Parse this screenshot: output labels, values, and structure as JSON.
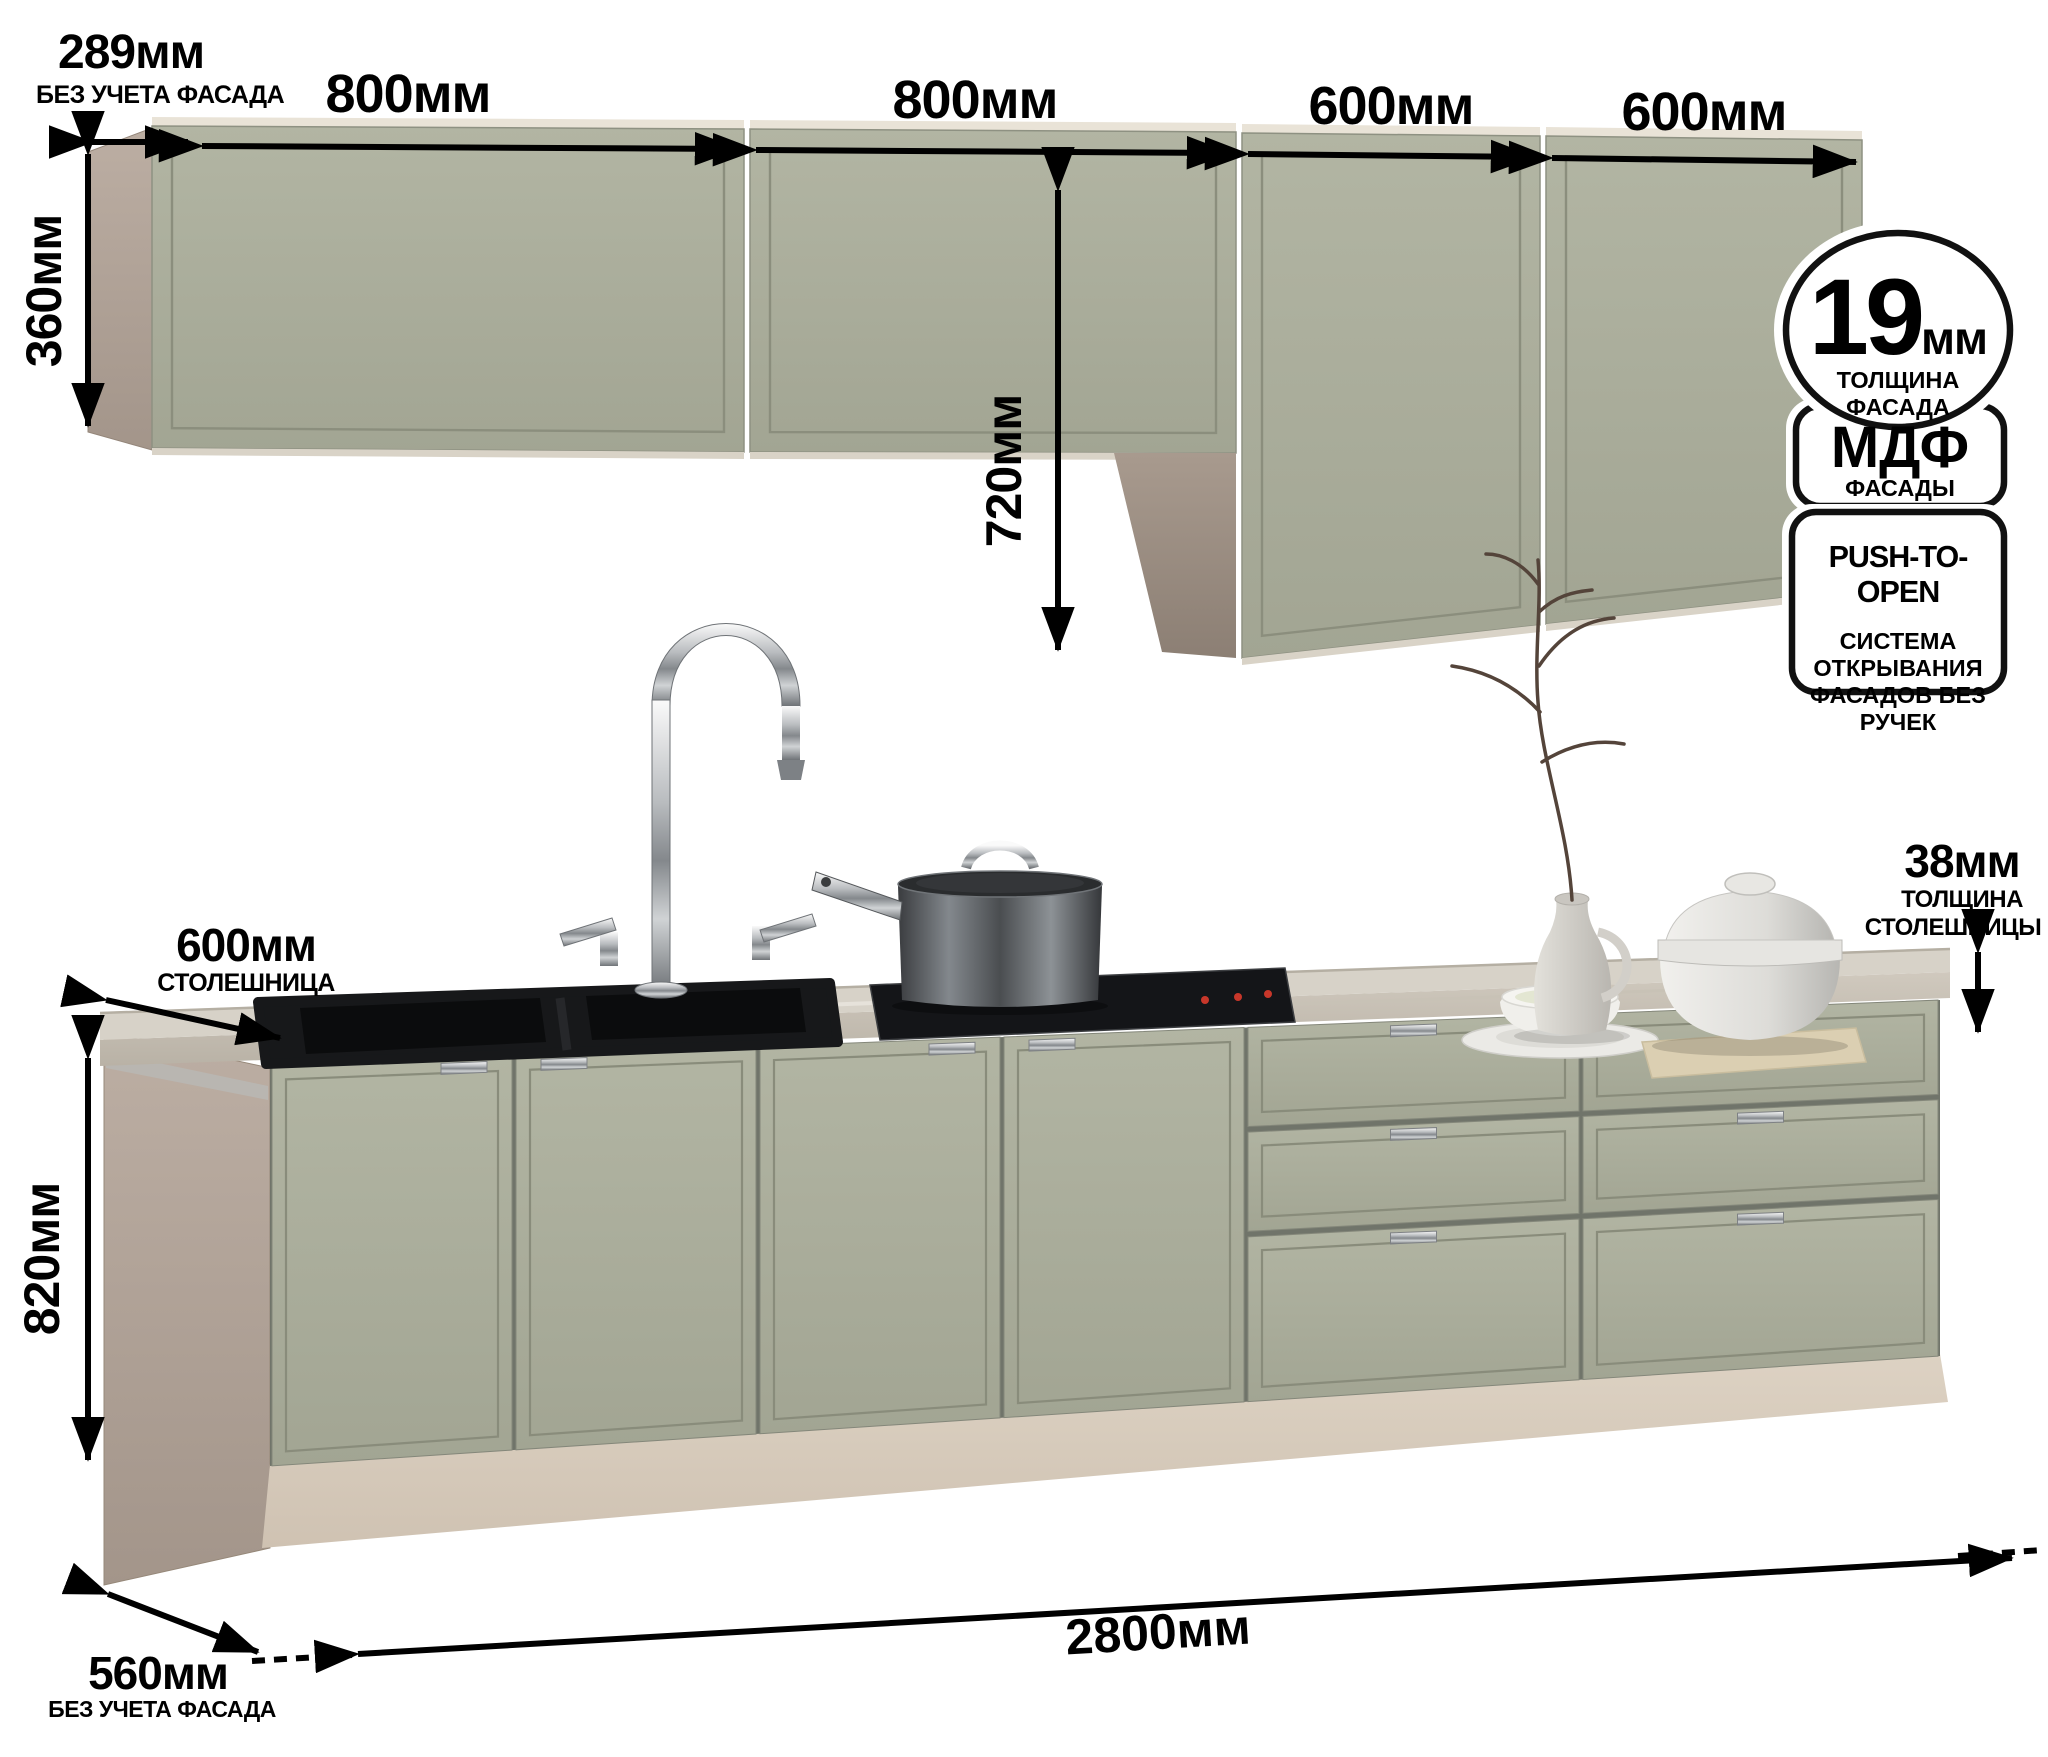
{
  "product": {
    "dimensions": {
      "side_depth_top": {
        "value": "289мм",
        "note": "БЕЗ УЧЕТА ФАСАДА"
      },
      "wall_cab_1": "800мм",
      "wall_cab_2": "800мм",
      "tall_cab_1": "600мм",
      "tall_cab_2": "600мм",
      "wall_cab_height": "360мм",
      "tall_cab_height": "720мм",
      "countertop_depth": {
        "value": "600мм",
        "note": "СТОЛЕШНИЦА"
      },
      "countertop_thickness": {
        "value": "38мм",
        "note1": "ТОЛЩИНА",
        "note2": "СТОЛЕШНИЦЫ"
      },
      "base_height": "820мм",
      "total_width": "2800мм",
      "base_depth": {
        "value": "560мм",
        "note": "БЕЗ УЧЕТА ФАСАДА"
      }
    },
    "badges": {
      "facade_thickness": {
        "value": "19",
        "unit": "мм",
        "line1": "ТОЛЩИНА",
        "line2": "ФАСАДА"
      },
      "material": {
        "title": "МДФ",
        "subtitle": "ФАСАДЫ"
      },
      "push_to_open": {
        "title": "PUSH-TO-OPEN",
        "lines": [
          "СИСТЕМА",
          "ОТКРЫВАНИЯ",
          "ФАСАДОВ БЕЗ",
          "РУЧЕК"
        ]
      }
    },
    "colors": {
      "facade_sage": "#a9ac9a",
      "carcass_taupe": "#b3a69b",
      "plinth_beige": "#d7cbbc",
      "countertop": "#d7d2c8",
      "annotation": "#000000"
    }
  }
}
